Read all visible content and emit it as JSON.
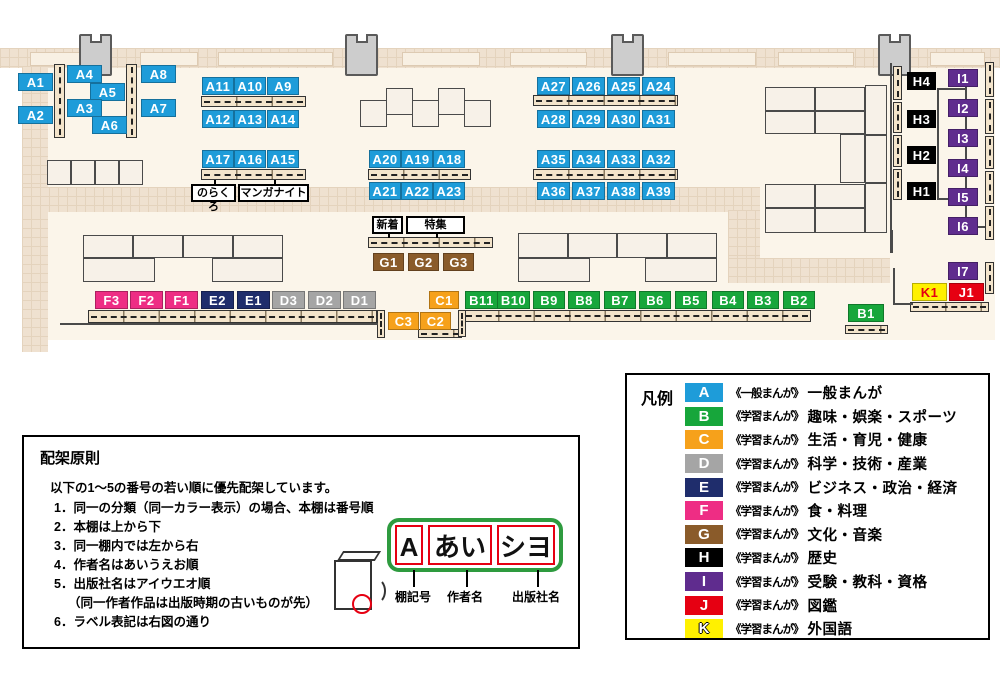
{
  "colors": {
    "A": "#1E9CD9",
    "B": "#17A63B",
    "C": "#F6A11B",
    "D": "#A5A5A5",
    "E": "#1F2D6C",
    "F": "#EE2D84",
    "G": "#8A5B2A",
    "H": "#000000",
    "I": "#5F2C8E",
    "J": "#E60012",
    "K": "#FFF100",
    "K_text": "#E60012"
  },
  "map": {
    "shelf_labels": [
      {
        "t": "A1",
        "x": 18,
        "y": 73,
        "w": 35,
        "c": "A"
      },
      {
        "t": "A2",
        "x": 18,
        "y": 106,
        "w": 35,
        "c": "A"
      },
      {
        "t": "A4",
        "x": 67,
        "y": 65,
        "w": 35,
        "c": "A"
      },
      {
        "t": "A5",
        "x": 90,
        "y": 83,
        "w": 35,
        "c": "A"
      },
      {
        "t": "A3",
        "x": 67,
        "y": 99,
        "w": 35,
        "c": "A"
      },
      {
        "t": "A6",
        "x": 92,
        "y": 116,
        "w": 35,
        "c": "A"
      },
      {
        "t": "A8",
        "x": 141,
        "y": 65,
        "w": 35,
        "c": "A"
      },
      {
        "t": "A7",
        "x": 141,
        "y": 99,
        "w": 35,
        "c": "A"
      },
      {
        "t": "A11",
        "x": 202,
        "y": 77,
        "w": 32,
        "c": "A"
      },
      {
        "t": "A10",
        "x": 234,
        "y": 77,
        "w": 32,
        "c": "A"
      },
      {
        "t": "A9",
        "x": 267,
        "y": 77,
        "w": 32,
        "c": "A"
      },
      {
        "t": "A12",
        "x": 202,
        "y": 110,
        "w": 32,
        "c": "A"
      },
      {
        "t": "A13",
        "x": 234,
        "y": 110,
        "w": 32,
        "c": "A"
      },
      {
        "t": "A14",
        "x": 267,
        "y": 110,
        "w": 32,
        "c": "A"
      },
      {
        "t": "A17",
        "x": 202,
        "y": 150,
        "w": 32,
        "c": "A"
      },
      {
        "t": "A16",
        "x": 234,
        "y": 150,
        "w": 32,
        "c": "A"
      },
      {
        "t": "A15",
        "x": 267,
        "y": 150,
        "w": 32,
        "c": "A"
      },
      {
        "t": "A20",
        "x": 369,
        "y": 150,
        "w": 32,
        "c": "A"
      },
      {
        "t": "A19",
        "x": 401,
        "y": 150,
        "w": 32,
        "c": "A"
      },
      {
        "t": "A18",
        "x": 433,
        "y": 150,
        "w": 32,
        "c": "A"
      },
      {
        "t": "A21",
        "x": 369,
        "y": 182,
        "w": 32,
        "c": "A"
      },
      {
        "t": "A22",
        "x": 401,
        "y": 182,
        "w": 32,
        "c": "A"
      },
      {
        "t": "A23",
        "x": 433,
        "y": 182,
        "w": 32,
        "c": "A"
      },
      {
        "t": "A27",
        "x": 537,
        "y": 77,
        "w": 33,
        "c": "A"
      },
      {
        "t": "A26",
        "x": 572,
        "y": 77,
        "w": 33,
        "c": "A"
      },
      {
        "t": "A25",
        "x": 607,
        "y": 77,
        "w": 33,
        "c": "A"
      },
      {
        "t": "A24",
        "x": 642,
        "y": 77,
        "w": 33,
        "c": "A"
      },
      {
        "t": "A28",
        "x": 537,
        "y": 110,
        "w": 33,
        "c": "A"
      },
      {
        "t": "A29",
        "x": 572,
        "y": 110,
        "w": 33,
        "c": "A"
      },
      {
        "t": "A30",
        "x": 607,
        "y": 110,
        "w": 33,
        "c": "A"
      },
      {
        "t": "A31",
        "x": 642,
        "y": 110,
        "w": 33,
        "c": "A"
      },
      {
        "t": "A35",
        "x": 537,
        "y": 150,
        "w": 33,
        "c": "A"
      },
      {
        "t": "A34",
        "x": 572,
        "y": 150,
        "w": 33,
        "c": "A"
      },
      {
        "t": "A33",
        "x": 607,
        "y": 150,
        "w": 33,
        "c": "A"
      },
      {
        "t": "A32",
        "x": 642,
        "y": 150,
        "w": 33,
        "c": "A"
      },
      {
        "t": "A36",
        "x": 537,
        "y": 182,
        "w": 33,
        "c": "A"
      },
      {
        "t": "A37",
        "x": 572,
        "y": 182,
        "w": 33,
        "c": "A"
      },
      {
        "t": "A38",
        "x": 607,
        "y": 182,
        "w": 33,
        "c": "A"
      },
      {
        "t": "A39",
        "x": 642,
        "y": 182,
        "w": 33,
        "c": "A"
      },
      {
        "t": "G1",
        "x": 373,
        "y": 253,
        "w": 31,
        "c": "G"
      },
      {
        "t": "G2",
        "x": 408,
        "y": 253,
        "w": 31,
        "c": "G"
      },
      {
        "t": "G3",
        "x": 443,
        "y": 253,
        "w": 31,
        "c": "G"
      },
      {
        "t": "F3",
        "x": 95,
        "y": 291,
        "w": 33,
        "c": "F"
      },
      {
        "t": "F2",
        "x": 130,
        "y": 291,
        "w": 33,
        "c": "F"
      },
      {
        "t": "F1",
        "x": 165,
        "y": 291,
        "w": 33,
        "c": "F"
      },
      {
        "t": "E2",
        "x": 201,
        "y": 291,
        "w": 33,
        "c": "E"
      },
      {
        "t": "E1",
        "x": 237,
        "y": 291,
        "w": 33,
        "c": "E"
      },
      {
        "t": "D3",
        "x": 272,
        "y": 291,
        "w": 33,
        "c": "D"
      },
      {
        "t": "D2",
        "x": 308,
        "y": 291,
        "w": 33,
        "c": "D"
      },
      {
        "t": "D1",
        "x": 343,
        "y": 291,
        "w": 33,
        "c": "D"
      },
      {
        "t": "C1",
        "x": 429,
        "y": 291,
        "w": 30,
        "c": "C"
      },
      {
        "t": "C3",
        "x": 388,
        "y": 312,
        "w": 31,
        "c": "C"
      },
      {
        "t": "C2",
        "x": 420,
        "y": 312,
        "w": 31,
        "c": "C"
      },
      {
        "t": "B11",
        "x": 465,
        "y": 291,
        "w": 33,
        "c": "B"
      },
      {
        "t": "B10",
        "x": 497,
        "y": 291,
        "w": 33,
        "c": "B"
      },
      {
        "t": "B9",
        "x": 533,
        "y": 291,
        "w": 32,
        "c": "B"
      },
      {
        "t": "B8",
        "x": 568,
        "y": 291,
        "w": 32,
        "c": "B"
      },
      {
        "t": "B7",
        "x": 604,
        "y": 291,
        "w": 32,
        "c": "B"
      },
      {
        "t": "B6",
        "x": 639,
        "y": 291,
        "w": 32,
        "c": "B"
      },
      {
        "t": "B5",
        "x": 675,
        "y": 291,
        "w": 32,
        "c": "B"
      },
      {
        "t": "B4",
        "x": 712,
        "y": 291,
        "w": 32,
        "c": "B"
      },
      {
        "t": "B3",
        "x": 747,
        "y": 291,
        "w": 32,
        "c": "B"
      },
      {
        "t": "B2",
        "x": 783,
        "y": 291,
        "w": 32,
        "c": "B"
      },
      {
        "t": "B1",
        "x": 848,
        "y": 304,
        "w": 36,
        "c": "B"
      },
      {
        "t": "H4",
        "x": 907,
        "y": 72,
        "w": 29,
        "c": "H"
      },
      {
        "t": "H3",
        "x": 907,
        "y": 110,
        "w": 29,
        "c": "H"
      },
      {
        "t": "H2",
        "x": 907,
        "y": 146,
        "w": 29,
        "c": "H"
      },
      {
        "t": "H1",
        "x": 907,
        "y": 182,
        "w": 29,
        "c": "H"
      },
      {
        "t": "I1",
        "x": 948,
        "y": 69,
        "w": 30,
        "c": "I"
      },
      {
        "t": "I2",
        "x": 948,
        "y": 99,
        "w": 30,
        "c": "I"
      },
      {
        "t": "I3",
        "x": 948,
        "y": 129,
        "w": 30,
        "c": "I"
      },
      {
        "t": "I4",
        "x": 948,
        "y": 159,
        "w": 30,
        "c": "I"
      },
      {
        "t": "I5",
        "x": 948,
        "y": 188,
        "w": 30,
        "c": "I"
      },
      {
        "t": "I6",
        "x": 948,
        "y": 217,
        "w": 30,
        "c": "I"
      },
      {
        "t": "I7",
        "x": 948,
        "y": 262,
        "w": 30,
        "c": "I"
      },
      {
        "t": "K1",
        "x": 912,
        "y": 283,
        "w": 35,
        "c": "K"
      },
      {
        "t": "J1",
        "x": 949,
        "y": 283,
        "w": 35,
        "c": "J"
      }
    ],
    "signs": [
      {
        "id": "norakuro",
        "text": "のらくろ",
        "x": 191,
        "y": 184,
        "w": 45,
        "pointer": "top"
      },
      {
        "id": "manga-night",
        "text": "マンガナイト",
        "x": 238,
        "y": 184,
        "w": 71,
        "pointer": "top"
      },
      {
        "id": "new-arrivals",
        "text": "新着",
        "x": 372,
        "y": 216,
        "w": 31,
        "pointer": "bottom"
      },
      {
        "id": "special-feature",
        "text": "特集",
        "x": 406,
        "y": 216,
        "w": 59,
        "pointer": "bottom"
      }
    ]
  },
  "legend": {
    "title": "凡例",
    "items": [
      {
        "code": "A",
        "scope": "《一般まんが》",
        "category": "一般まんが"
      },
      {
        "code": "B",
        "scope": "《学習まんが》",
        "category": "趣味・娯楽・スポーツ"
      },
      {
        "code": "C",
        "scope": "《学習まんが》",
        "category": "生活・育児・健康"
      },
      {
        "code": "D",
        "scope": "《学習まんが》",
        "category": "科学・技術・産業"
      },
      {
        "code": "E",
        "scope": "《学習まんが》",
        "category": "ビジネス・政治・経済"
      },
      {
        "code": "F",
        "scope": "《学習まんが》",
        "category": "食・料理"
      },
      {
        "code": "G",
        "scope": "《学習まんが》",
        "category": "文化・音楽"
      },
      {
        "code": "H",
        "scope": "《学習まんが》",
        "category": "歴史"
      },
      {
        "code": "I",
        "scope": "《学習まんが》",
        "category": "受験・教科・資格"
      },
      {
        "code": "J",
        "scope": "《学習まんが》",
        "category": "図鑑"
      },
      {
        "code": "K",
        "scope": "《学習まんが》",
        "category": "外国語"
      }
    ]
  },
  "rules": {
    "title": "配架原則",
    "intro": "以下の1～5の番号の若い順に優先配架しています。",
    "items": [
      "1．同一の分類（同一カラー表示）の場合、本棚は番号順",
      "2．本棚は上から下",
      "3．同一棚内では左から右",
      "4．作者名はあいうえお順",
      "5．出版社名はアイウエオ順",
      "（同一作者作品は出版時期の古いものが先）",
      "6．ラベル表記は右図の通り"
    ],
    "label_example": {
      "shelf_code": "A",
      "author": "あい",
      "publisher": "シヨ"
    },
    "label_captions": [
      "棚記号",
      "作者名",
      "出版社名"
    ]
  }
}
